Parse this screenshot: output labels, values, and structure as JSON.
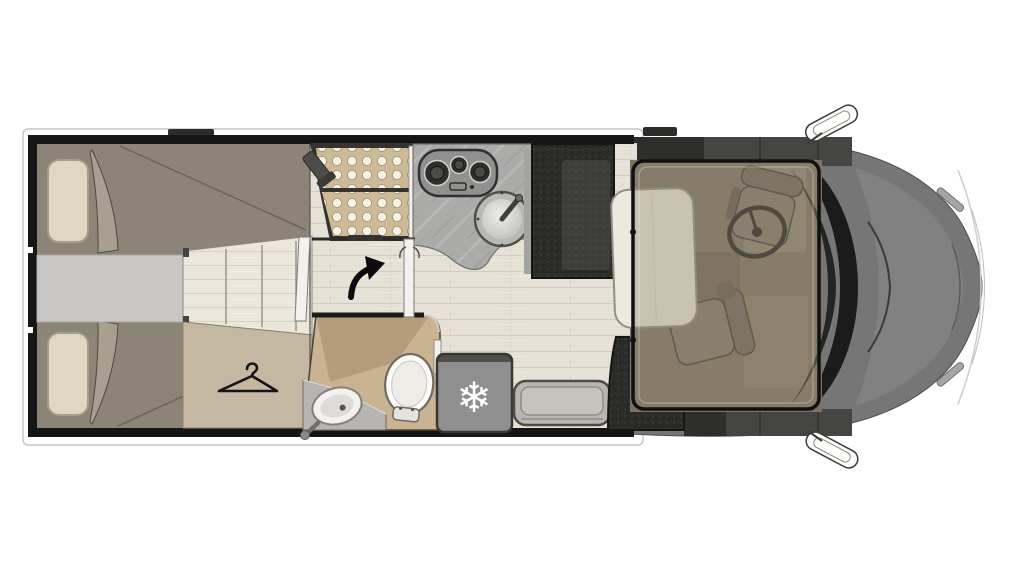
{
  "meta": {
    "title": "Motorhome floor plan (top view)",
    "diagram_type": "vehicle interior layout"
  },
  "icons": {
    "snowflake": "❄",
    "names": [
      "hanger-icon",
      "snowflake-icon",
      "turn-arrow-icon",
      "stove-icon",
      "sink-icon",
      "toilet-icon",
      "washbasin-icon",
      "steering-wheel-icon",
      "shower-head-icon",
      "side-mirror-icon"
    ]
  },
  "colors": {
    "c-wall": "#161616",
    "c-floor": "#e6e1d5",
    "c-bed": "#8d8478",
    "c-pillow": "#ded8c3",
    "c-aisle": "#c9c7c5",
    "c-wardrobe": "#c4b8a3",
    "c-shower": "#cdbb97",
    "c-counter": "#ababa9",
    "c-darkbench": "#2b2b29",
    "c-fridge": "#8f8f8f",
    "c-step": "#b9b6b1",
    "c-bathroom": "#c9b393",
    "c-table": "#eceadf",
    "c-cab": "#767676",
    "c-hood": "#818181",
    "c-windshield": "#1b1b1b",
    "c-white": "#ffffff"
  },
  "legend": {
    "depicted_features": [
      "two single beds with pillows at the rear",
      "central aisle step between beds",
      "wardrobe area marked with clothes hanger",
      "shower cabin with dotted tray",
      "kitchen block with 3-burner hob and round sink",
      "washroom with toilet and oval washbasin",
      "refrigerator marked with snowflake",
      "entry step at side door",
      "dinette: table with two dark bench seats",
      "swivelled cab seats and steering wheel",
      "drop-down bed frame shown lowered over cab",
      "vehicle cab exterior with windshield and side mirrors"
    ]
  }
}
